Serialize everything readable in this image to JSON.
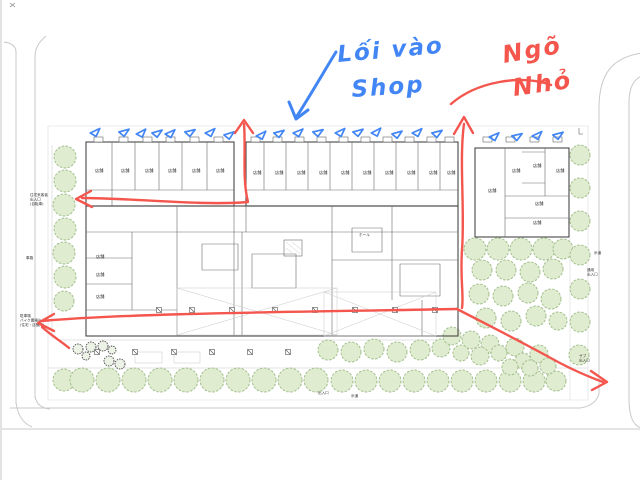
{
  "image_type": "architectural site plan with handwritten markup",
  "annotations": {
    "shop_entrance_note": {
      "line1": "Lối vào",
      "line2": "Shop",
      "color": "#4286f5"
    },
    "alley_note": {
      "line1": "Ngõ",
      "line2": "Nhỏ",
      "color": "#f4564e"
    },
    "shop_entry_tick_count": 22,
    "red_route_arrow_count": 5
  },
  "plan": {
    "room_label": "店舗",
    "room_label_count": 25,
    "small_labels": [
      {
        "name": "resident-visitor-entrance",
        "lines": [
          "住宅来客者",
          "出入口",
          "(自転車)"
        ]
      },
      {
        "name": "parking-bike-entrance",
        "lines": [
          "駐車場",
          "バイク置場出入口",
          "(住宅・店舗用)"
        ]
      },
      {
        "name": "sidewalk-east",
        "lines": [
          "歩道"
        ]
      },
      {
        "name": "service-entrance",
        "lines": [
          "通用",
          "出入口"
        ]
      },
      {
        "name": "sub-entrance",
        "lines": [
          "サブ",
          "出入口"
        ]
      },
      {
        "name": "pedestrian-entrance",
        "lines": [
          "出入口"
        ]
      },
      {
        "name": "sidewalk-south",
        "lines": [
          "歩道"
        ]
      },
      {
        "name": "hall",
        "lines": [
          "ホール"
        ]
      },
      {
        "name": "roadway",
        "lines": [
          "車路"
        ]
      }
    ]
  },
  "colors": {
    "annotation_blue": "#4286f5",
    "annotation_red": "#f4564e",
    "tree_fill": "#dfeccf",
    "tree_stroke": "#a3bf8e",
    "plan_line": "#474747",
    "road_line": "#c9c9c9",
    "background": "#ffffff"
  }
}
